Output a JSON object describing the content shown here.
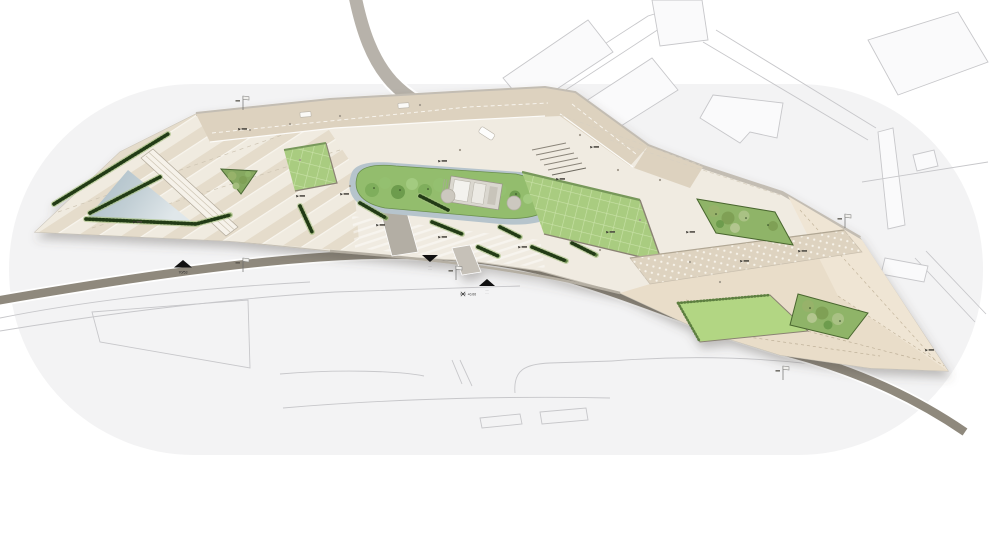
{
  "drawing": {
    "kind": "landscape-site-plan",
    "annotations": {
      "entrance_left": {
        "glyph": "▲",
        "label": "70/53"
      },
      "entrance_down": {
        "glyph": "▼",
        "line1": "·····",
        "line2": "····"
      },
      "entrance_up": {
        "glyph": "▲",
        "line1": "·····",
        "line2": "····"
      },
      "spot_level": {
        "label": "+0.00"
      }
    },
    "palette": {
      "canvas_blob": "#f3f3f4",
      "plaza": "#f0ebe1",
      "paving_band": "#ddd2bf",
      "stripe_dark": "#e5dccb",
      "lawn": "#a9cc80",
      "lawn_grid": "#c9e2a8",
      "shrub": "#8fb468",
      "hedge": "#5d7f3f",
      "water_dark": "#a7bac4",
      "water_light": "#e0e7ea",
      "road_dark": "#8f897d",
      "road_light": "#b7b2aa",
      "slope": "#e9ddc9",
      "dotted_band": "#ded3c0",
      "context_line": "#c7c7ca"
    }
  }
}
